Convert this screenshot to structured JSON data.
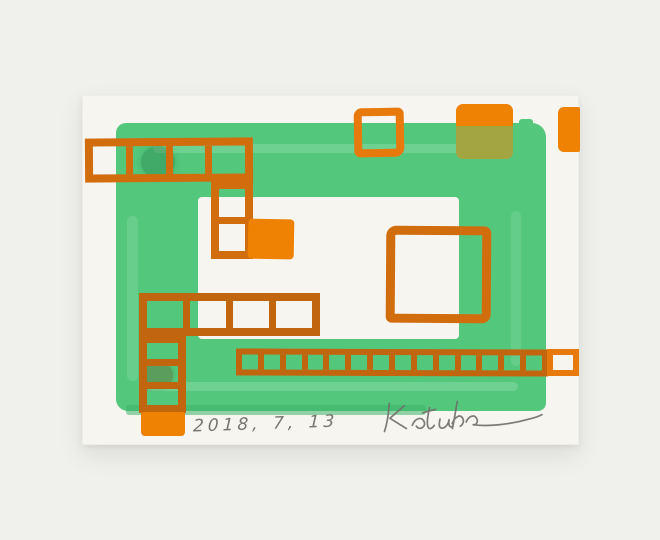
{
  "colors": {
    "background": "#f0f0ed",
    "paper": "#f6f5ef",
    "green": "#53c87d",
    "green_deep": "#3db26a",
    "orange": "#e8790c",
    "orange_dark": "#c2650f",
    "orange_mid": "#d26d0e",
    "orange_fill": "#ef8103",
    "pencil": "#76766f"
  },
  "inscription": {
    "date": "2018, 7, 13",
    "signature": "Katuha"
  }
}
